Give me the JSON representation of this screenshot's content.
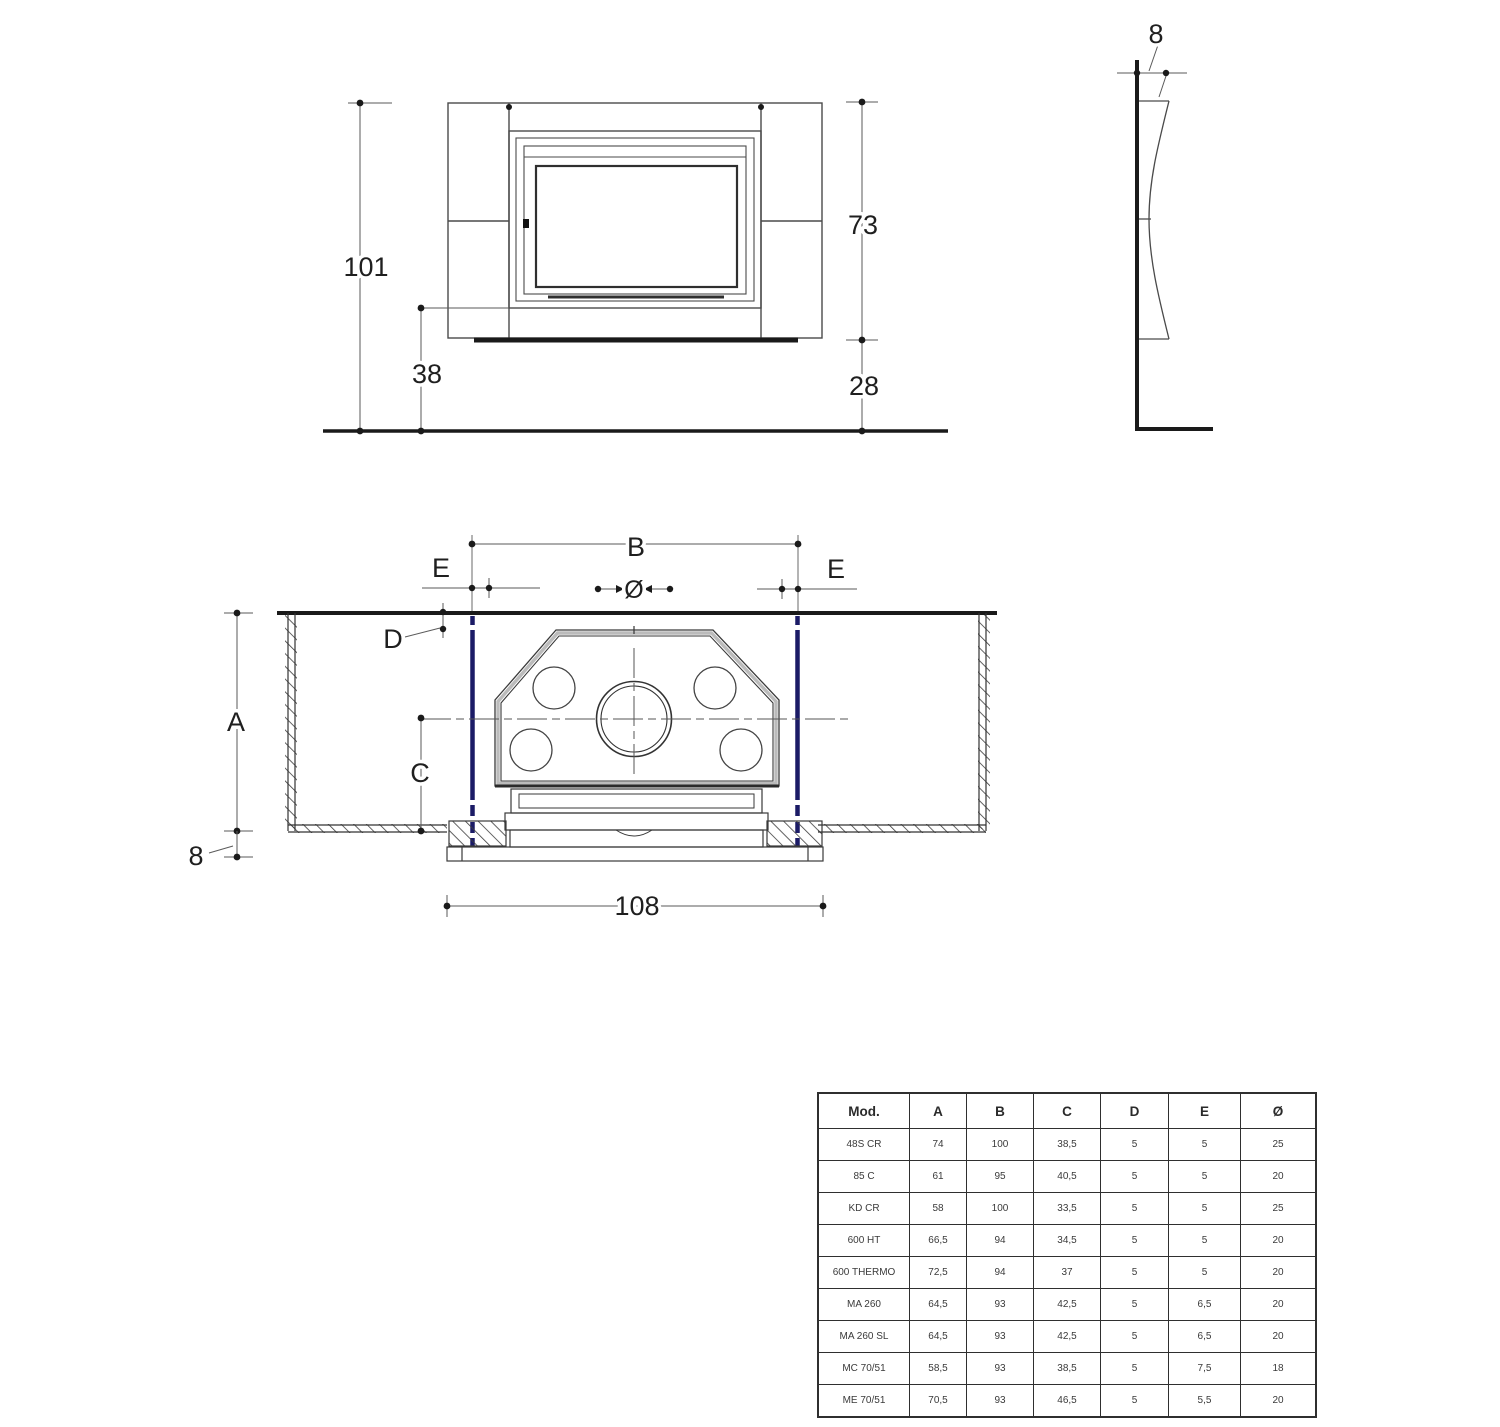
{
  "colors": {
    "line": "#2b2b2b",
    "dim_line": "#5a5a5a",
    "accent_blue": "#1b1b66",
    "background": "#ffffff"
  },
  "front_view": {
    "labels": {
      "total_height": "101",
      "firebox_height": "73",
      "hearth_height": "38",
      "plinth_height": "28"
    }
  },
  "side_view": {
    "labels": {
      "panel_depth": "8"
    }
  },
  "plan_view": {
    "labels": {
      "recess_width": "B",
      "clearance_left": "E",
      "clearance_right": "E",
      "flue_diameter": "Ø",
      "wall_thickness": "D",
      "recess_depth": "A",
      "flue_center_depth": "C",
      "slab_thickness": "8",
      "overall_width": "108"
    }
  },
  "table": {
    "headers": [
      "Mod.",
      "A",
      "B",
      "C",
      "D",
      "E",
      "Ø"
    ],
    "rows": [
      [
        "48S CR",
        "74",
        "100",
        "38,5",
        "5",
        "5",
        "25"
      ],
      [
        "85 C",
        "61",
        "95",
        "40,5",
        "5",
        "5",
        "20"
      ],
      [
        "KD CR",
        "58",
        "100",
        "33,5",
        "5",
        "5",
        "25"
      ],
      [
        "600 HT",
        "66,5",
        "94",
        "34,5",
        "5",
        "5",
        "20"
      ],
      [
        "600 THERMO",
        "72,5",
        "94",
        "37",
        "5",
        "5",
        "20"
      ],
      [
        "MA 260",
        "64,5",
        "93",
        "42,5",
        "5",
        "6,5",
        "20"
      ],
      [
        "MA 260 SL",
        "64,5",
        "93",
        "42,5",
        "5",
        "6,5",
        "20"
      ],
      [
        "MC 70/51",
        "58,5",
        "93",
        "38,5",
        "5",
        "7,5",
        "18"
      ],
      [
        "ME 70/51",
        "70,5",
        "93",
        "46,5",
        "5",
        "5,5",
        "20"
      ]
    ]
  }
}
